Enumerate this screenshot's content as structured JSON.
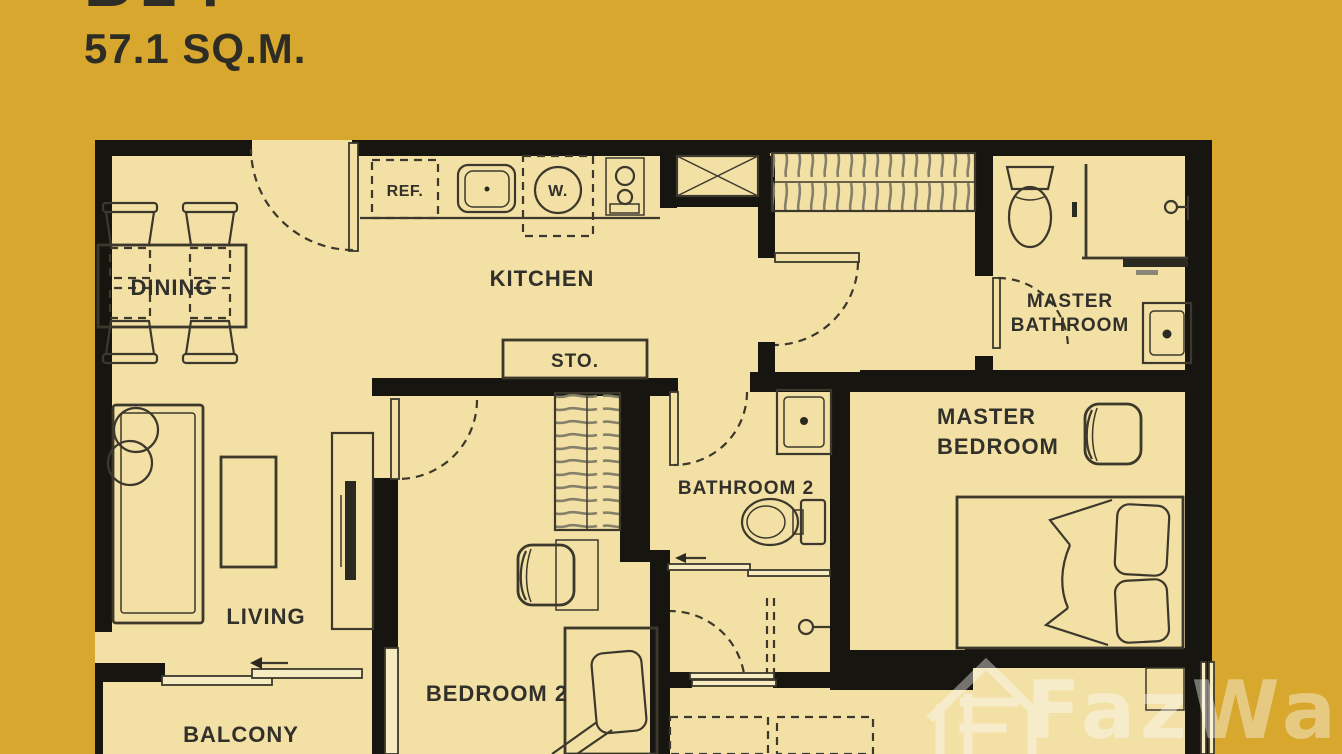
{
  "header": {
    "title_partial": "B14",
    "area": "57.1 SQ.M."
  },
  "labels": {
    "dining": "DINING",
    "kitchen": "KITCHEN",
    "storage": "STO.",
    "living": "LIVING",
    "balcony": "BALCONY",
    "bedroom2": "BEDROOM 2",
    "bathroom2": "BATHROOM 2",
    "master_bathroom_line1": "MASTER",
    "master_bathroom_line2": "BATHROOM",
    "master_bedroom_line1": "MASTER",
    "master_bedroom_line2": "BEDROOM",
    "refrigerator": "REF.",
    "washer": "W."
  },
  "watermark": {
    "brand": "FazWaz"
  },
  "colors": {
    "background": "#D7A72E",
    "floor": "#F3E0A5",
    "wall": "#17150F",
    "line": "#3C392C",
    "label": "#32302A",
    "watermark": "#FFFFFF"
  }
}
